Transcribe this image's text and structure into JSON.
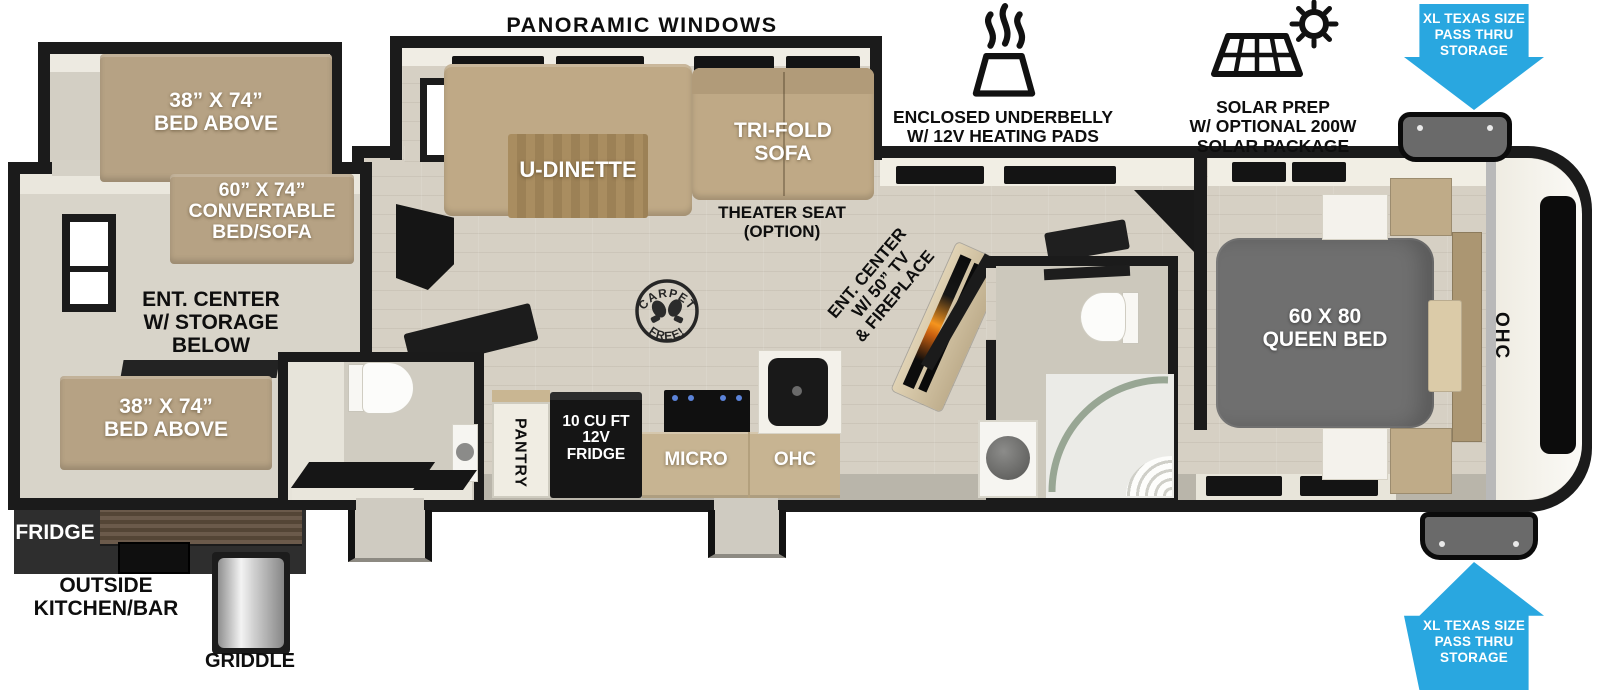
{
  "header": {
    "panoramic_windows": "PANORAMIC WINDOWS",
    "underbelly": {
      "line1": "ENCLOSED UNDERBELLY",
      "line2": "W/ 12V HEATING PADS"
    },
    "solar": {
      "line1": "SOLAR PREP",
      "line2": "W/ OPTIONAL 200W",
      "line3": "SOLAR PACKAGE"
    },
    "pass_thru_storage": {
      "line1": "XL TEXAS SIZE",
      "line2": "PASS THRU",
      "line3": "STORAGE"
    }
  },
  "rear_section": {
    "bunk_top": {
      "line1": "38” X 74”",
      "line2": "BED ABOVE"
    },
    "convertible_bed": {
      "line1": "60” X 74”",
      "line2": "CONVERTABLE",
      "line3": "BED/SOFA"
    },
    "ent_center_storage": {
      "line1": "ENT. CENTER",
      "line2": "W/ STORAGE",
      "line3": "BELOW"
    },
    "bunk_bottom": {
      "line1": "38” X 74”",
      "line2": "BED ABOVE"
    }
  },
  "living": {
    "u_dinette": "U-DINETTE",
    "tri_fold_sofa": {
      "line1": "TRI-FOLD",
      "line2": "SOFA"
    },
    "theater_seat": {
      "line1": "THEATER SEAT",
      "line2": "(OPTION)"
    },
    "carpet_free": {
      "arc_top": "CARPET",
      "arc_bottom": "FREE!"
    },
    "ent_center_tv": {
      "line1": "ENT. CENTER",
      "line2": "W/ 50” TV",
      "line3": "& FIREPLACE"
    }
  },
  "kitchen": {
    "pantry": "PANTRY",
    "fridge": {
      "line1": "10 CU FT",
      "line2": "12V",
      "line3": "FRIDGE"
    },
    "micro": "MICRO",
    "ohc": "OHC"
  },
  "bedroom": {
    "queen_bed": {
      "line1": "60 X 80",
      "line2": "QUEEN BED"
    },
    "ohc": "OHC"
  },
  "exterior": {
    "fridge": "FRIDGE",
    "outside_kitchen": {
      "line1": "OUTSIDE",
      "line2": "KITCHEN/BAR"
    },
    "griddle": "GRIDDLE"
  },
  "icons": {
    "underbelly": "heat-waves-pad",
    "solar": "solar-panel-with-sun",
    "pass_thru": "blue-directional-arrow",
    "carpet_free": "round-stamp-with-boot-prints"
  },
  "colors": {
    "arrow_blue": "#29a7e0",
    "wall": "#1b1b1b",
    "furniture_tan": "#b6a284",
    "cabinet_tan": "#c7b492",
    "queen_bed_gray": "#6f6f6f",
    "floor": "#d6d0c4"
  }
}
